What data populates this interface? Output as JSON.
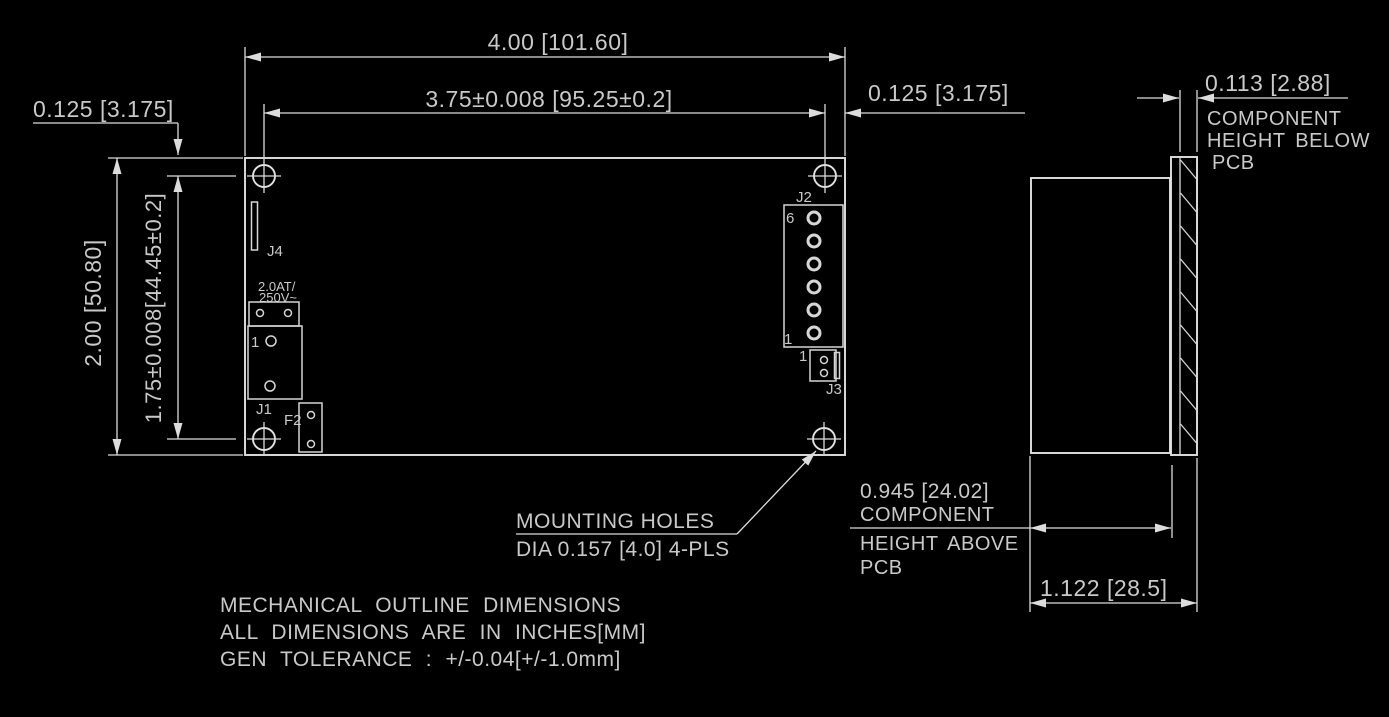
{
  "drawing": {
    "background": "#000000",
    "line_color": "#dcdcdc",
    "text_color": "#c9c9c9",
    "top_view": {
      "dim_width": "4.00 [101.60]",
      "dim_hole_span_h": "3.75±0.008 [95.25±0.2]",
      "dim_edge_offset_left": "0.125 [3.175]",
      "dim_edge_offset_right": "0.125 [3.175]",
      "dim_height": "2.00 [50.80]",
      "dim_hole_span_v": "1.75±0.008[44.45±0.2]",
      "labels": {
        "j4": "J4",
        "j1": "J1",
        "j2": "J2",
        "j3": "J3",
        "f2": "F2",
        "fuse_rating_line1": "2.0AT/",
        "fuse_rating_line2": "250V~",
        "j1_pin1": "1",
        "j2_pin_top": "6",
        "j2_pin_bottom": "1",
        "j3_pin1": "1"
      },
      "mounting_note_line1": "MOUNTING HOLES",
      "mounting_note_line2": "DIA 0.157 [4.0] 4-PLS"
    },
    "side_view": {
      "dim_below_pcb": "0.113 [2.88]",
      "below_pcb_label_line1": "COMPONENT",
      "below_pcb_label_line2": "HEIGHT BELOW",
      "below_pcb_label_line3": "PCB",
      "dim_above_pcb": "0.945 [24.02]",
      "above_pcb_label_line1": "COMPONENT",
      "above_pcb_label_line2": "HEIGHT ABOVE",
      "above_pcb_label_line3": "PCB",
      "dim_total": "1.122 [28.5]"
    },
    "notes": [
      "MECHANICAL OUTLINE DIMENSIONS",
      "ALL DIMENSIONS ARE IN INCHES[MM]",
      "GEN TOLERANCE : +/-0.04[+/-1.0mm]"
    ]
  }
}
